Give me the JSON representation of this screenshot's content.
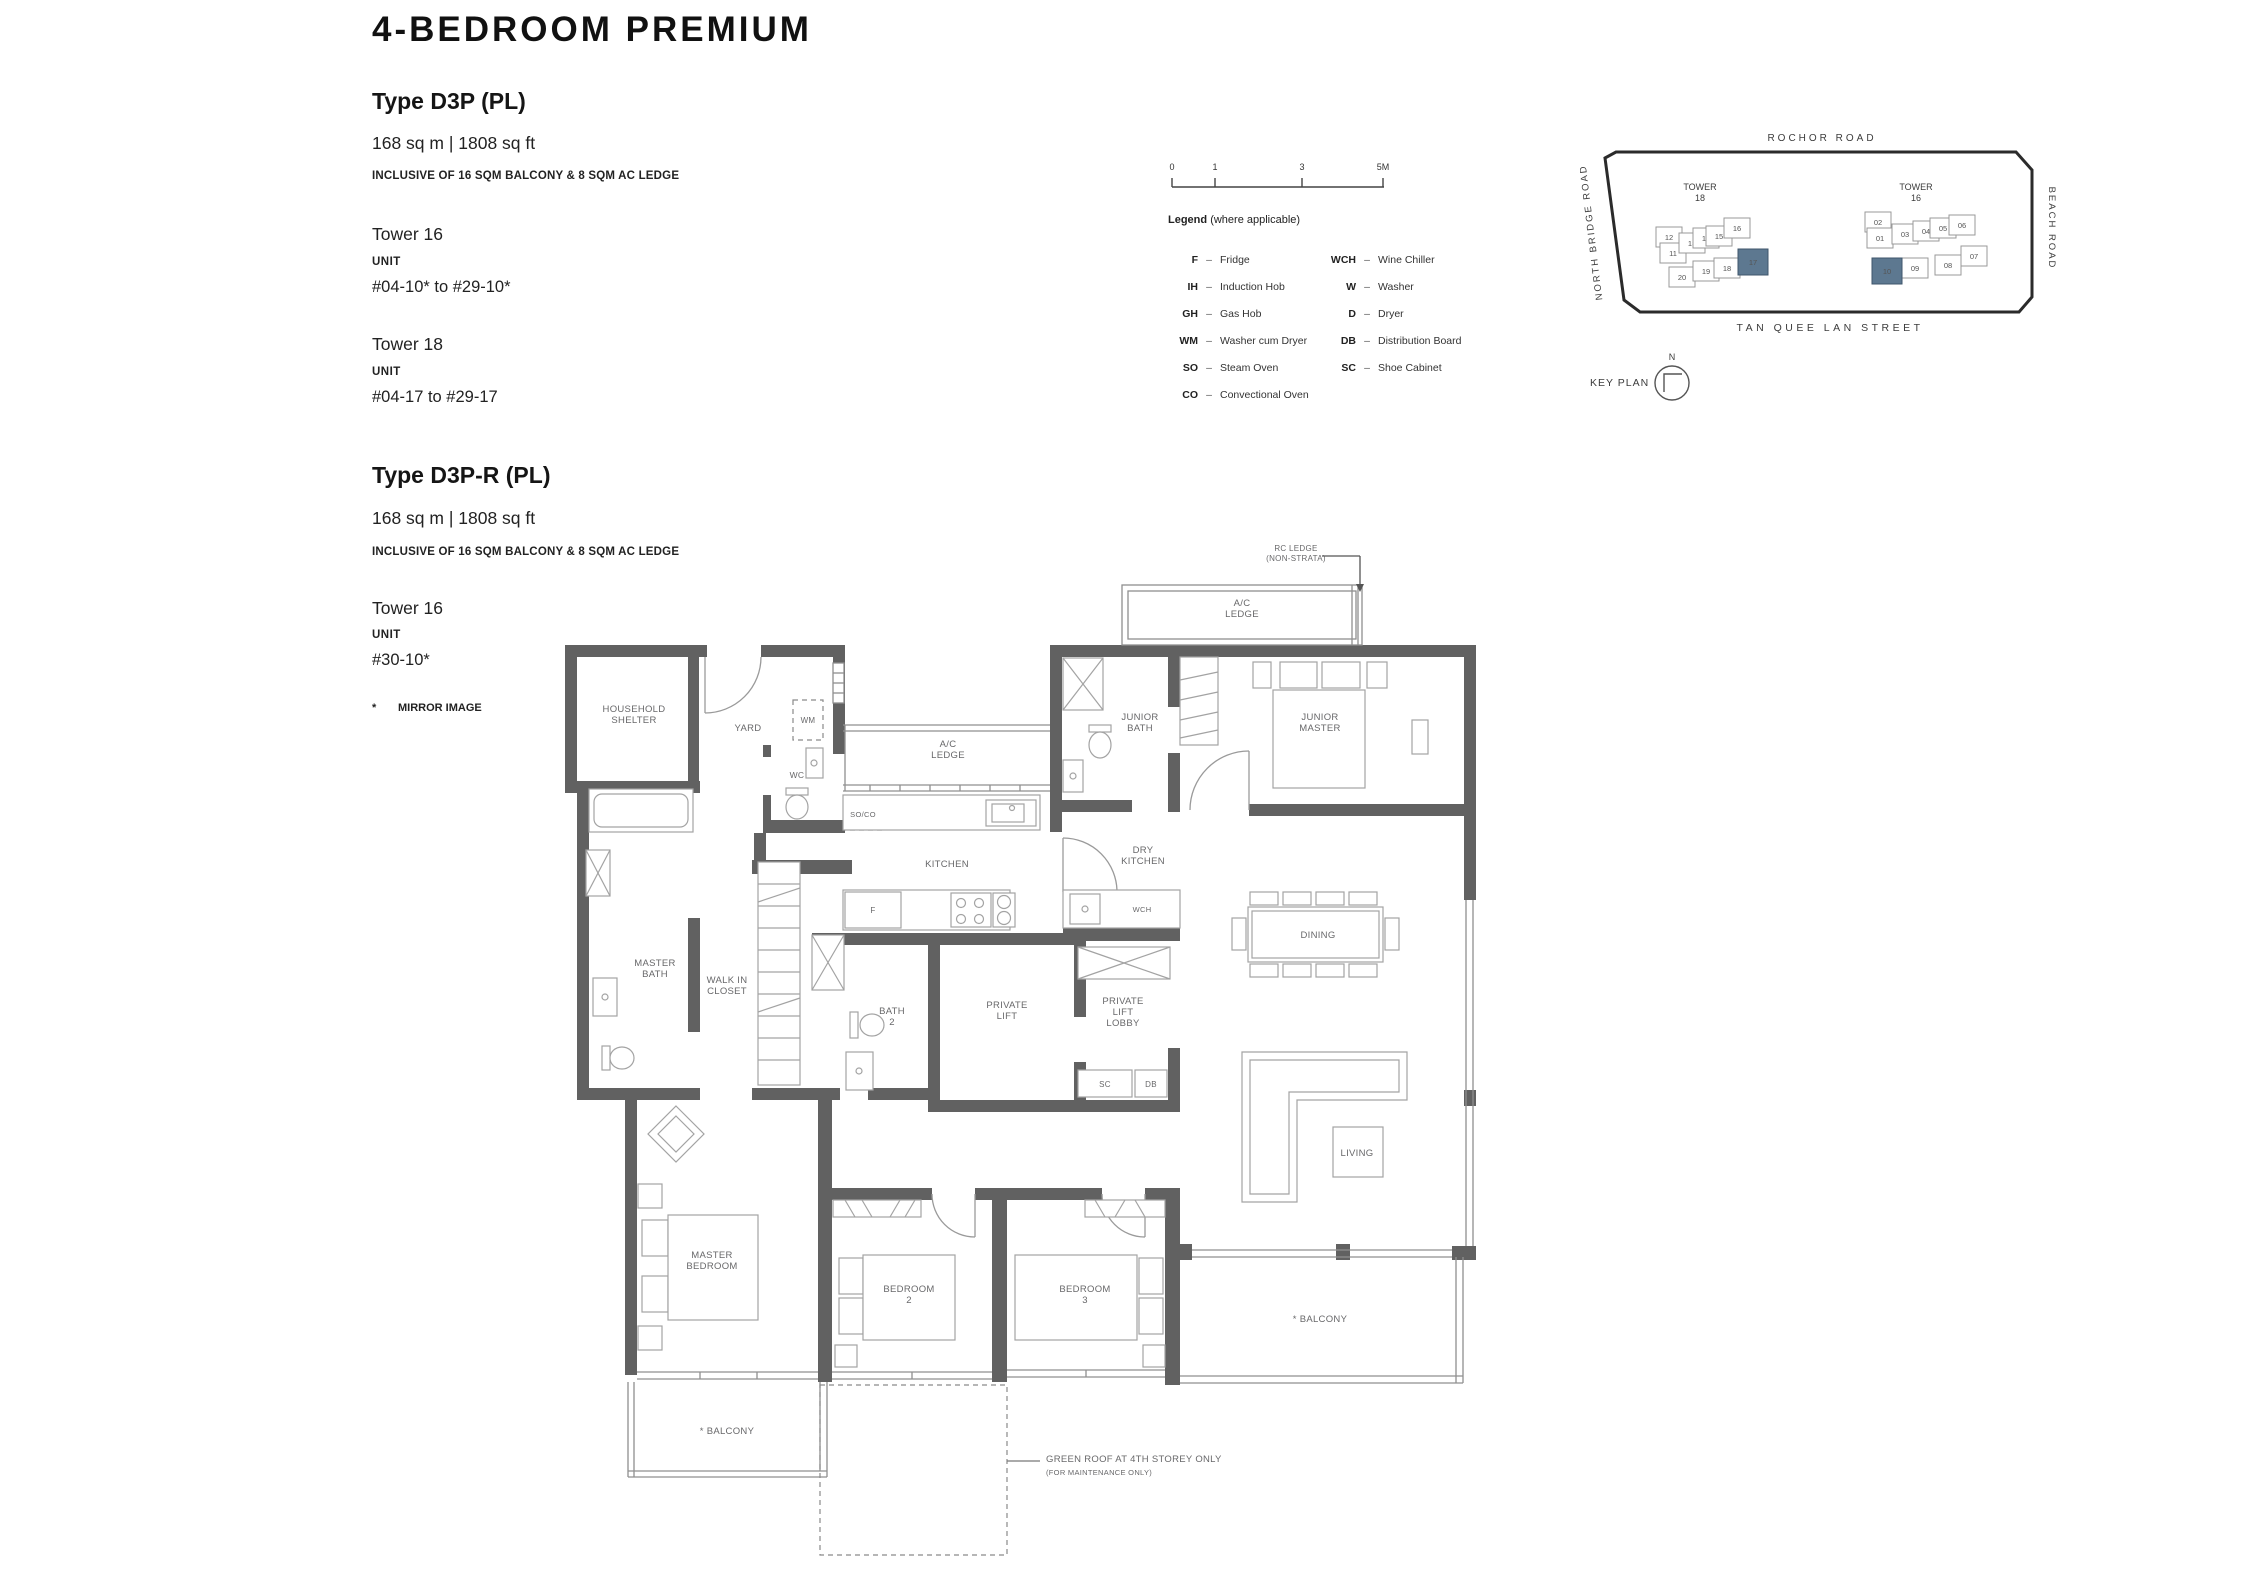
{
  "page": {
    "title": "4-BEDROOM PREMIUM",
    "mirror_star": "*",
    "mirror_note": "MIRROR IMAGE"
  },
  "type_d3p": {
    "heading": "Type D3P (PL)",
    "area": "168 sq m | 1808 sq ft",
    "inclusive": "INCLUSIVE OF 16 SQM BALCONY & 8 SQM AC LEDGE",
    "towers": [
      {
        "name": "Tower 16",
        "unit_label": "UNIT",
        "range": "#04-10* to #29-10*"
      },
      {
        "name": "Tower 18",
        "unit_label": "UNIT",
        "range": "#04-17 to #29-17"
      }
    ]
  },
  "type_d3p_r": {
    "heading": "Type D3P-R (PL)",
    "area": "168 sq m | 1808 sq ft",
    "inclusive": "INCLUSIVE OF 16 SQM BALCONY & 8 SQM AC LEDGE",
    "towers": [
      {
        "name": "Tower 16",
        "unit_label": "UNIT",
        "range": "#30-10*"
      }
    ]
  },
  "scale_bar": {
    "labels": [
      "0",
      "1",
      "3",
      "5M"
    ]
  },
  "legend": {
    "title": "Legend",
    "subtitle": "(where applicable)",
    "col1": [
      {
        "key": "F",
        "value": "Fridge"
      },
      {
        "key": "IH",
        "value": "Induction Hob"
      },
      {
        "key": "GH",
        "value": "Gas Hob"
      },
      {
        "key": "WM",
        "value": "Washer cum Dryer"
      },
      {
        "key": "SO",
        "value": "Steam Oven"
      },
      {
        "key": "CO",
        "value": "Convectional Oven"
      }
    ],
    "col2": [
      {
        "key": "WCH",
        "value": "Wine Chiller"
      },
      {
        "key": "W",
        "value": "Washer"
      },
      {
        "key": "D",
        "value": "Dryer"
      },
      {
        "key": "DB",
        "value": "Distribution Board"
      },
      {
        "key": "SC",
        "value": "Shoe Cabinet"
      }
    ]
  },
  "key_plan": {
    "label": "KEY PLAN",
    "north": "N",
    "roads": {
      "top": "ROCHOR ROAD",
      "left": "NORTH BRIDGE ROAD",
      "right": "BEACH ROAD",
      "bottom": "TAN QUEE LAN STREET"
    },
    "tower_left": {
      "line1": "TOWER",
      "line2": "18"
    },
    "tower_right": {
      "line1": "TOWER",
      "line2": "16"
    },
    "highlight_color": "#5d7890",
    "units": [
      {
        "label": "12",
        "x": 1669,
        "y": 237,
        "hl": false
      },
      {
        "label": "11",
        "x": 1673,
        "y": 253,
        "hl": false
      },
      {
        "label": "13",
        "x": 1692,
        "y": 243,
        "hl": false
      },
      {
        "label": "14",
        "x": 1706,
        "y": 238,
        "hl": false
      },
      {
        "label": "15",
        "x": 1719,
        "y": 236,
        "hl": false
      },
      {
        "label": "16",
        "x": 1737,
        "y": 228,
        "hl": false
      },
      {
        "label": "20",
        "x": 1682,
        "y": 277,
        "hl": false
      },
      {
        "label": "19",
        "x": 1706,
        "y": 271,
        "hl": false
      },
      {
        "label": "18",
        "x": 1727,
        "y": 268,
        "hl": false
      },
      {
        "label": "17",
        "x": 1753,
        "y": 262,
        "hl": true
      },
      {
        "label": "02",
        "x": 1878,
        "y": 222,
        "hl": false
      },
      {
        "label": "01",
        "x": 1880,
        "y": 238,
        "hl": false
      },
      {
        "label": "03",
        "x": 1905,
        "y": 234,
        "hl": false
      },
      {
        "label": "04",
        "x": 1926,
        "y": 231,
        "hl": false
      },
      {
        "label": "05",
        "x": 1943,
        "y": 228,
        "hl": false
      },
      {
        "label": "06",
        "x": 1962,
        "y": 225,
        "hl": false
      },
      {
        "label": "07",
        "x": 1974,
        "y": 256,
        "hl": false
      },
      {
        "label": "08",
        "x": 1948,
        "y": 265,
        "hl": false
      },
      {
        "label": "09",
        "x": 1915,
        "y": 268,
        "hl": false
      },
      {
        "label": "10",
        "x": 1887,
        "y": 271,
        "hl": true
      }
    ]
  },
  "floor_plan": {
    "labels": [
      {
        "lines": [
          "RC LEDGE",
          "(NON-STRATA)"
        ],
        "x": 1296,
        "y": 551,
        "size": 8,
        "lh": 10
      },
      {
        "lines": [
          "A/C",
          "LEDGE"
        ],
        "x": 1242,
        "y": 606
      },
      {
        "lines": [
          "HOUSEHOLD",
          "SHELTER"
        ],
        "x": 634,
        "y": 712
      },
      {
        "lines": [
          "YARD"
        ],
        "x": 748,
        "y": 731
      },
      {
        "lines": [
          "WM"
        ],
        "x": 808,
        "y": 723,
        "size": 8
      },
      {
        "lines": [
          "WC"
        ],
        "x": 797,
        "y": 778,
        "size": 8.5
      },
      {
        "lines": [
          "A/C",
          "LEDGE"
        ],
        "x": 948,
        "y": 747
      },
      {
        "lines": [
          "SO/CO"
        ],
        "x": 863,
        "y": 817,
        "size": 7.5
      },
      {
        "lines": [
          "KITCHEN"
        ],
        "x": 947,
        "y": 867
      },
      {
        "lines": [
          "DRY",
          "KITCHEN"
        ],
        "x": 1143,
        "y": 853
      },
      {
        "lines": [
          "JUNIOR",
          "BATH"
        ],
        "x": 1140,
        "y": 720
      },
      {
        "lines": [
          "JUNIOR",
          "MASTER"
        ],
        "x": 1320,
        "y": 720
      },
      {
        "lines": [
          "F"
        ],
        "x": 873,
        "y": 913,
        "size": 8
      },
      {
        "lines": [
          "WCH"
        ],
        "x": 1142,
        "y": 912,
        "size": 7.5
      },
      {
        "lines": [
          "MASTER",
          "BATH"
        ],
        "x": 655,
        "y": 966
      },
      {
        "lines": [
          "WALK IN",
          "CLOSET"
        ],
        "x": 727,
        "y": 983
      },
      {
        "lines": [
          "BATH",
          "2"
        ],
        "x": 892,
        "y": 1014
      },
      {
        "lines": [
          "PRIVATE",
          "LIFT"
        ],
        "x": 1007,
        "y": 1008
      },
      {
        "lines": [
          "PRIVATE",
          "LIFT",
          "LOBBY"
        ],
        "x": 1123,
        "y": 1004
      },
      {
        "lines": [
          "SC"
        ],
        "x": 1105,
        "y": 1087,
        "size": 8
      },
      {
        "lines": [
          "DB"
        ],
        "x": 1151,
        "y": 1087,
        "size": 8
      },
      {
        "lines": [
          "DINING"
        ],
        "x": 1318,
        "y": 938
      },
      {
        "lines": [
          "LIVING"
        ],
        "x": 1357,
        "y": 1156
      },
      {
        "lines": [
          "MASTER",
          "BEDROOM"
        ],
        "x": 712,
        "y": 1258
      },
      {
        "lines": [
          "BEDROOM",
          "2"
        ],
        "x": 909,
        "y": 1292
      },
      {
        "lines": [
          "BEDROOM",
          "3"
        ],
        "x": 1085,
        "y": 1292
      },
      {
        "lines": [
          "* BALCONY"
        ],
        "x": 1320,
        "y": 1322
      },
      {
        "lines": [
          "* BALCONY"
        ],
        "x": 727,
        "y": 1434
      },
      {
        "lines": [
          "GREEN ROOF AT 4TH STOREY ONLY"
        ],
        "x": 1046,
        "y": 1462,
        "size": 9.5,
        "anchor": "start"
      },
      {
        "lines": [
          "(FOR MAINTENANCE ONLY)"
        ],
        "x": 1046,
        "y": 1475,
        "size": 7.5,
        "anchor": "start"
      }
    ]
  }
}
